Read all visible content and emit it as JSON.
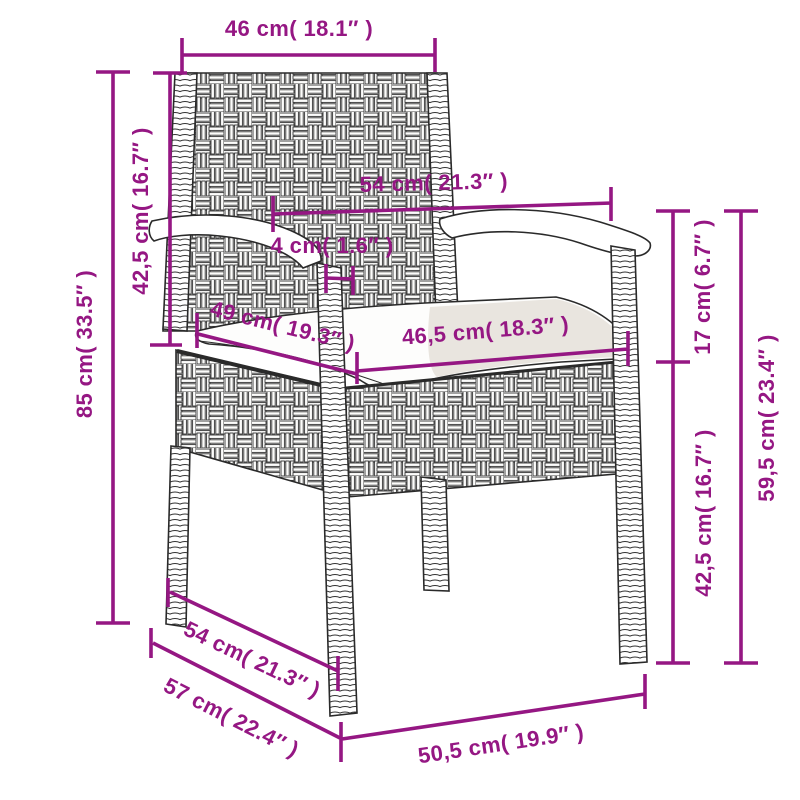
{
  "colors": {
    "dimension": "#951783",
    "line_art": "#2a2a2a",
    "cushion_fill": "#fdfdfc",
    "cushion_shade": "#e9e5df",
    "background": "#ffffff"
  },
  "dimensions": {
    "backrest_width": "46 cm( 18.1″ )",
    "backrest_height": "42,5 cm( 16.7″ )",
    "total_height": "85 cm( 33.5″ )",
    "armrest_span": "54 cm( 21.3″ )",
    "armrest_post_thickness": "4 cm( 1.6″ )",
    "seat_depth": "49 cm( 19.3″ )",
    "seat_width": "46,5 cm( 18.3″ )",
    "armrest_above_seat": "17 cm( 6.7″ )",
    "seat_to_ground": "42,5 cm( 16.7″ )",
    "armrest_height": "59,5 cm( 23.4″ )",
    "leg_depth_inner": "54 cm( 21.3″ )",
    "base_depth": "57 cm( 22.4″ )",
    "front_width": "50,5 cm( 19.9″ )"
  }
}
